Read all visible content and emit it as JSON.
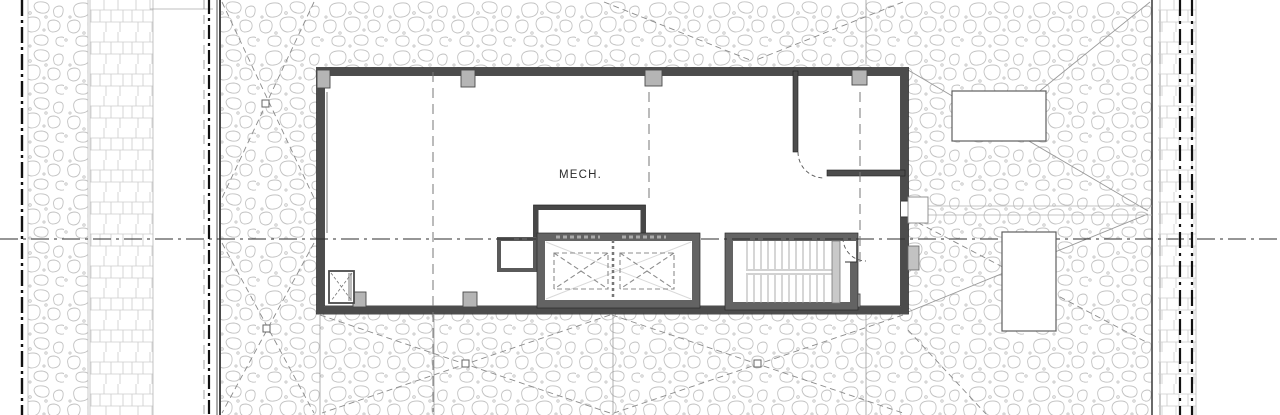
{
  "plan": {
    "room_labels": [
      {
        "id": "mech",
        "label": "MECH."
      }
    ],
    "features": [
      "property-line",
      "gravel-strip",
      "paver-walkway",
      "ballasted-roof-field",
      "roof-cricket-lines",
      "roof-drain",
      "mechanical-penthouse",
      "elevator-shaft",
      "elevator-cab",
      "stair-enclosure",
      "roof-monitor",
      "roof-hatch",
      "equipment-pad",
      "roof-access-door",
      "partition-door"
    ],
    "counts": {
      "roof_drains": 4,
      "equipment_pads": 2,
      "elevator_cabs": 2
    },
    "colors": {
      "wall": "#4c4c4c",
      "shaft_wall": "#636363",
      "column": "#b5b5b5",
      "stone_hatch": "#c3c3c3",
      "paver_hatch": "#cccccc",
      "cricket_line": "#8a8a8a",
      "grid_line": "#2e2e2e",
      "property_line": "#111111",
      "background": "#ffffff"
    }
  }
}
